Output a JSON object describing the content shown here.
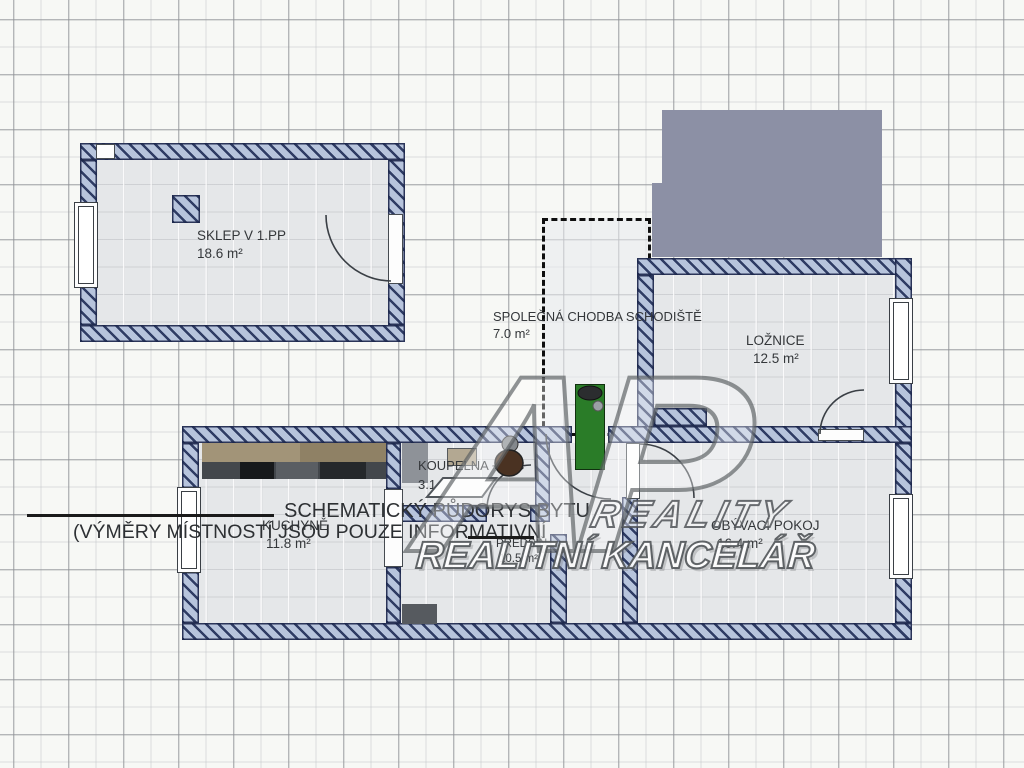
{
  "plan": {
    "rooms": [
      {
        "name": "SKLEP V 1.PP",
        "area": "18.6 m²"
      },
      {
        "name": "SPOLEČNÁ CHODBA SCHODIŠTĚ",
        "area": "7.0 m²"
      },
      {
        "name": "LOŽNICE",
        "area": "12.5 m²"
      },
      {
        "name": "KUCHYNĚ",
        "area": "11.8 m²"
      },
      {
        "name": "KOUPELNA + WC",
        "area": "3.1 m²"
      },
      {
        "name": "PŘEDSÍŇ",
        "area": "10.5 m²"
      },
      {
        "name": "OBÝVACÍ POKOJ",
        "area": "16.4 m²"
      }
    ],
    "notes": {
      "line1": "SCHEMATICKÝ PŮDORYS BYTU",
      "line2": "(VÝMĚRY MÍSTNOSTÍ JSOU POUZE INFORMATIVNÍ"
    },
    "watermark": {
      "monogram": "AP",
      "line1": "REALITY",
      "line2": "REALITNÍ KANCELÁŘ"
    },
    "colors": {
      "background": "#f7f8f5",
      "room_floor": "#e5e7e9",
      "wall_fill": "#b7c4dc",
      "wall_stripe": "#2f3c64",
      "staircase_block": "#8c90a5",
      "entrance_door_green": "#2a7c28",
      "counter_tan": "#a29478",
      "appliance_dark": "#43474c",
      "toilet_brown": "#4a3222"
    }
  }
}
